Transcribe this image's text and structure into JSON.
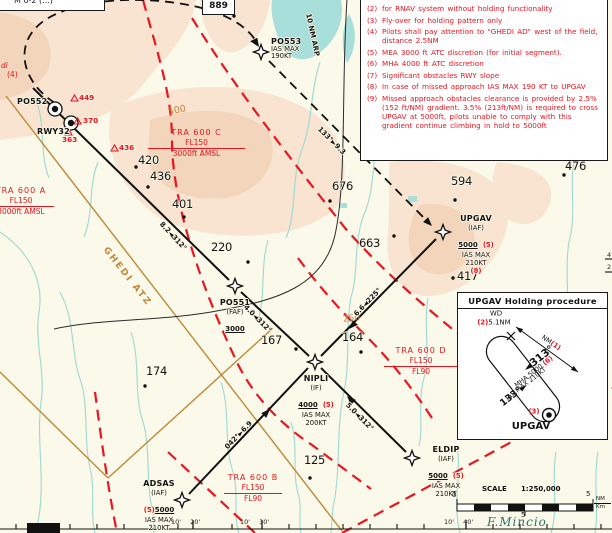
{
  "misc": {
    "cut_label": "M 0-2 (...)",
    "elev_box": "889",
    "right_edge_a": "4",
    "right_edge_b": "2"
  },
  "notes": [
    {
      "n": "(2)",
      "t": "for RNAV system without holding functionality"
    },
    {
      "n": "(3)",
      "t": "Fly-over for holding pattern only"
    },
    {
      "n": "(4)",
      "t": "Pilots shall pay attention to \"GHEDI AD\" west of the field, distance 2.5NM"
    },
    {
      "n": "(5)",
      "t": "MEA 3000 ft ATC discretion (for initial segment)."
    },
    {
      "n": "(6)",
      "t": "MHA 4000 ft ATC discretion"
    },
    {
      "n": "(7)",
      "t": "Significant obstacles RWY slope"
    },
    {
      "n": "(8)",
      "t": "In case of missed approach IAS MAX 190 KT to UPGAV"
    },
    {
      "n": "(9)",
      "t": "Missed approach obstacles clearance is provided by 2.5% (152 ft/NM) gradient. 3.5% (213ft/NM) is required to cross UPGAV at 5000ft, pilots unable to comply with this gradient continue climbing in hold to 5000ft"
    }
  ],
  "waypoints": {
    "po553": {
      "name": "PO553",
      "l1": "IAS MAX",
      "l2": "190KT"
    },
    "po552": {
      "name": "PO552"
    },
    "rwy32": {
      "name": "RWY32"
    },
    "po551": {
      "name": "PO551",
      "type": "(FAF)",
      "alt": "3000"
    },
    "nipli": {
      "name": "NIPLI",
      "type": "(IF)",
      "alt": "4000",
      "note": "(5)",
      "l1": "IAS MAX",
      "l2": "200KT"
    },
    "upgav": {
      "name": "UPGAV",
      "type": "(IAF)",
      "alt": "5000",
      "note": "(5)",
      "l1": "IAS MAX",
      "l2": "210KT",
      "note2": "(8)"
    },
    "eldip": {
      "name": "ELDIP",
      "type": "(IAF)",
      "alt": "5000",
      "note": "(5)",
      "l1": "IAS MAX",
      "l2": "210KT"
    },
    "adsas": {
      "name": "ADSAS",
      "type": "(IAF)",
      "note": "(5)",
      "alt": "5000",
      "l1": "IAS MAX",
      "l2": "210KT"
    }
  },
  "legs": {
    "rwy": "8.2◄312°",
    "faf": "4.0◄312°",
    "upgav": "6.6◄225°",
    "eldip": "5.0◄312°",
    "adsas": "042°►6.9",
    "missed": "133°►9.3",
    "arc": "10 NM ARP"
  },
  "spots": [
    {
      "v": "420"
    },
    {
      "v": "436"
    },
    {
      "v": "401"
    },
    {
      "v": "676"
    },
    {
      "v": "663"
    },
    {
      "v": "594"
    },
    {
      "v": "476"
    },
    {
      "v": "417"
    },
    {
      "v": "220"
    },
    {
      "v": "167"
    },
    {
      "v": "164"
    },
    {
      "v": "174"
    },
    {
      "v": "125"
    }
  ],
  "obstacles": [
    {
      "v": "449"
    },
    {
      "v": "370"
    },
    {
      "v": "436"
    },
    {
      "v": "363"
    }
  ],
  "tra": {
    "a": {
      "name": "TRA 600 A",
      "top": "FL150",
      "bottom": "3000ft AMSL"
    },
    "b": {
      "name": "TRA 600 B",
      "top": "FL150",
      "bottom": "FL90"
    },
    "c": {
      "name": "TRA 600 C",
      "top": "FL150",
      "bottom": "3000ft AMSL"
    },
    "d": {
      "name": "TRA 600 D",
      "top": "FL150",
      "bottom": "FL90"
    }
  },
  "terrain_labels": {
    "atz": "GHEDI ATZ",
    "c500": "500",
    "c250": "250",
    "river": "F.Mincio",
    "ghedi_frag_1": "di",
    "ghedi_frag_2": "(4)"
  },
  "holding": {
    "title": "UPGAV Holding procedure",
    "wd": "WD",
    "wd_note": "(2)",
    "wd_val": "5.1NM",
    "dim": "NM",
    "dim_note": "(1)",
    "inbound": "◄313°",
    "mha": "MHA 5000",
    "mha_note": "(6)",
    "ias": "IAS MAX 210KT",
    "outbound": "133°►",
    "fix_note": "(3)",
    "fix": "UPGAV"
  },
  "scalebar": {
    "label": "SCALE",
    "ratio": "1:250,000",
    "zero": "0",
    "five": "5",
    "nm": "NM",
    "km": "Km",
    "mid": "5"
  },
  "graticule": {
    "a1": "10'",
    "a2": "20'",
    "b1": "10'",
    "b2": "30'",
    "c1": "10'",
    "c2": "40'"
  },
  "colors": {
    "red": "#e8141e",
    "tan": "#c4863b",
    "peach": "#f8e4d1",
    "peach_dark": "#f3d5bb",
    "water": "#9ed8d2",
    "ink": "#141414"
  }
}
